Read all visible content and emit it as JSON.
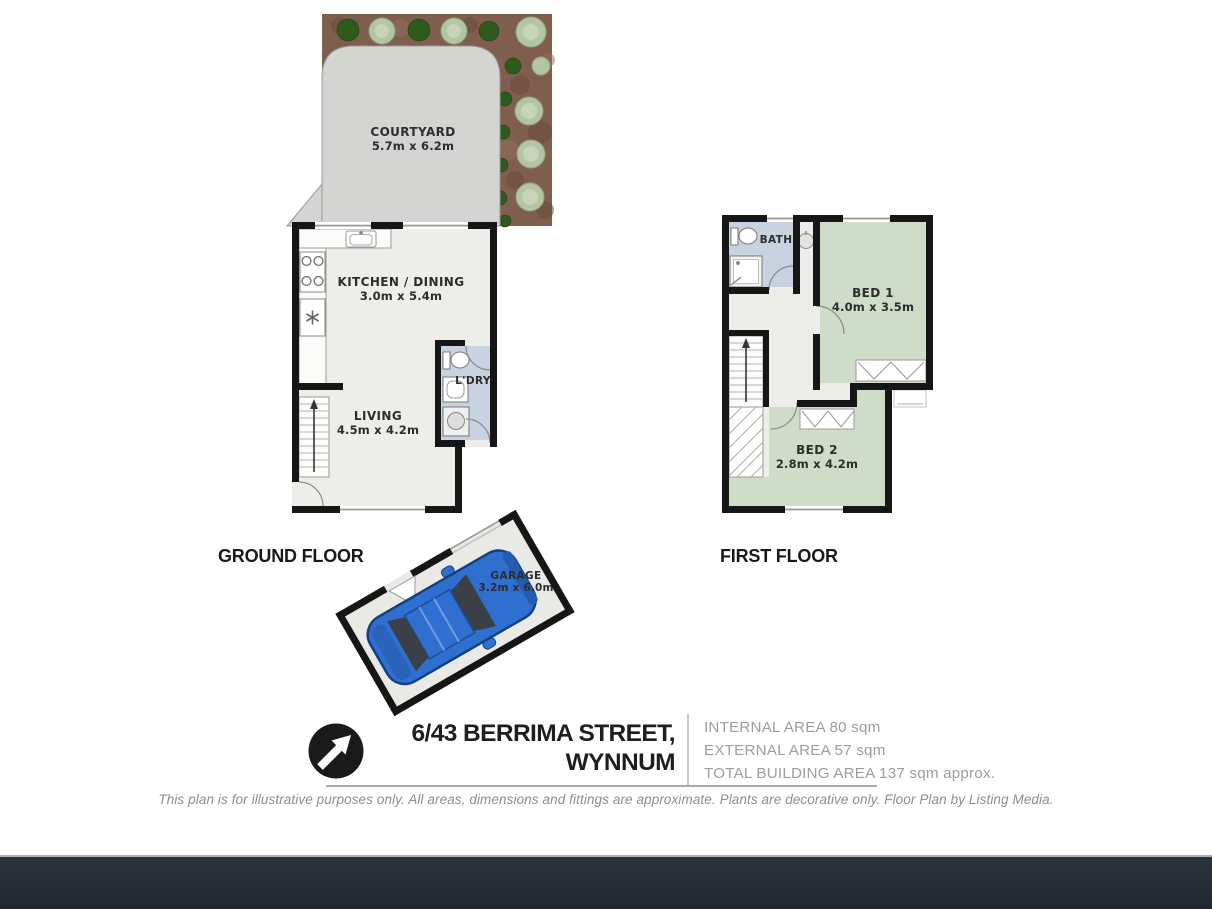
{
  "ground_floor": {
    "label": "GROUND FLOOR",
    "courtyard_name": "COURTYARD",
    "courtyard_dims": "5.7m x 6.2m",
    "kitchen_name": "KITCHEN / DINING",
    "kitchen_dims": "3.0m x 5.4m",
    "living_name": "LIVING",
    "living_dims": "4.5m x 4.2m",
    "laundry_name": "L'DRY"
  },
  "first_floor": {
    "label": "FIRST FLOOR",
    "bath_name": "BATH",
    "bed1_name": "BED 1",
    "bed1_dims": "4.0m x 3.5m",
    "bed2_name": "BED 2",
    "bed2_dims": "2.8m x 4.2m"
  },
  "garage": {
    "name": "GARAGE",
    "dims": "3.2m x 6.0m"
  },
  "footer": {
    "address_line1": "6/43 BERRIMA STREET,",
    "address_line2": "WYNNUM",
    "area_internal": "INTERNAL AREA 80 sqm",
    "area_external": "EXTERNAL AREA 57 sqm",
    "area_total": "TOTAL BUILDING AREA 137 sqm approx.",
    "disclaimer": "This plan is for illustrative purposes only. All areas, dimensions and fittings are approximate. Plants are decorative only. Floor Plan by Listing Media."
  },
  "colors": {
    "wall": "#161616",
    "room_fill": "#edede9",
    "bedroom_green": "#cfdcc7",
    "wet_area_blue": "#c7d3e1",
    "courtyard_gray": "#d4d4d2",
    "garden_brown": "#7f5e4d",
    "tree_light": "#b3c5a2",
    "tree_dark": "#2e5a1c",
    "car_blue": "#2f6fd0",
    "footer_bar": "#242b34"
  }
}
